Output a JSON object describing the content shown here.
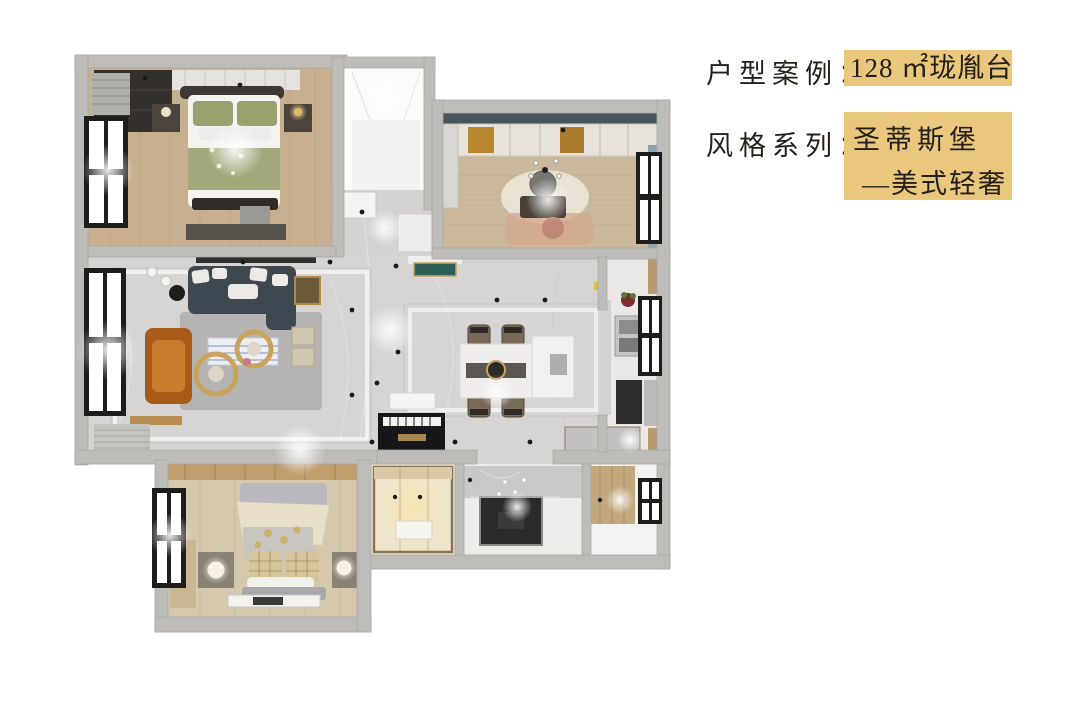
{
  "page": {
    "background": "#ffffff"
  },
  "header": {
    "case_label": "户型案例：",
    "case_value": "128 ㎡珑胤台",
    "style_label": "风格系列：",
    "style_value_line1": "圣蒂斯堡",
    "style_value_line2": "—美式轻奢",
    "highlight_color": "#e9c77c",
    "text_color": "#241f19"
  },
  "floorplan": {
    "type": "3d-top-down-apartment-render",
    "area_sqm": "128",
    "rooms": [
      "master-bedroom",
      "entry-balcony",
      "study",
      "living-room",
      "hallway-dining",
      "kitchen",
      "second-bedroom",
      "cloak-room",
      "bathroom",
      "rear-balcony"
    ],
    "palette": {
      "wall": "#bdbcb9",
      "wall_shade": "#a9a8a5",
      "wood_floor": "#c7af8f",
      "study_floor": "#cbb79b",
      "bedroom2_floor": "#d5c8ad",
      "marble_floor": "#d6d5d3",
      "sofa": "#3d4850",
      "armchair_leather": "#b5651d",
      "bedding_green": "#a3a87b",
      "bedding_cream": "#e6dcc4",
      "gold_accent": "#c9a45e",
      "shower_dark": "#2a2a28"
    }
  }
}
